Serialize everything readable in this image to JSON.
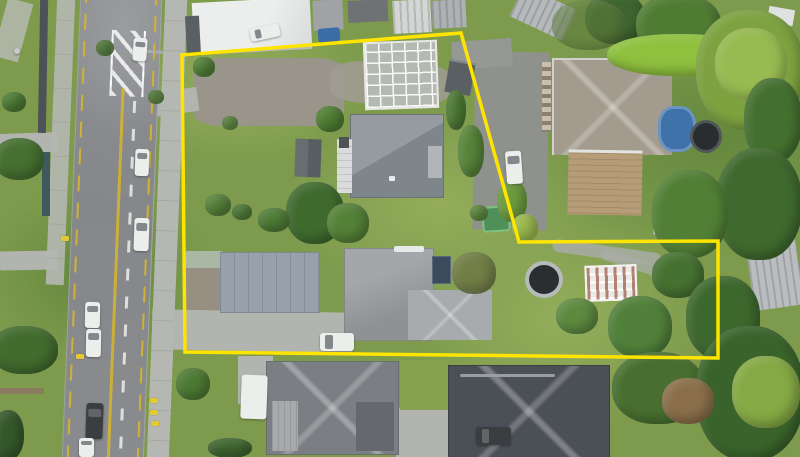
{
  "scene": {
    "kind": "aerial-drone-photo",
    "subject": "residential property lots outlined with a yellow boundary beside a suburban road",
    "visible_text": "none"
  },
  "boundary": {
    "points": "182,55 461,33 519,242 718,241 718,358 185,352",
    "color": "#ffe400",
    "stroke_width": 3.5
  },
  "palette": {
    "grass": "#7e9b4d",
    "grassLight": "#93ad5b",
    "grassDark": "#64883d",
    "road": "#87898c",
    "roadLight": "#9a9c9f",
    "path": "#b5b8b2",
    "concrete": "#b2b4b0",
    "laneYellow": "#d8b62a",
    "laneWhite": "#eceeec",
    "roofGray": "#8d9399",
    "roofHouse2": "#9b9ea1",
    "roofMid": "#7b7f83",
    "roofDark": "#4b4f56",
    "roofTan": "#a39b8e",
    "deckWood": "#b79d77",
    "carportWhite": "#d9dbdc",
    "garageBlue": "#98a1ab",
    "greenRoof": "#a9b8a4",
    "gravel": "#9a958b",
    "poolBlue": "#3f72a8",
    "spaDark": "#2a2d30",
    "tramRing": "#b7babb",
    "tramDark": "#2b2e31",
    "shedGreen": "#4f9058",
    "white": "#eceeec",
    "carDark": "#3b3e41",
    "solar": "#3d4a5c"
  },
  "objects": [
    "road-with-centerline",
    "median-hatch",
    "footpaths",
    "warehouse-roof",
    "yard-sheds",
    "greenhouse",
    "house-top-lot",
    "carport",
    "garden-shed",
    "neighbour-house-ne",
    "timber-deck",
    "blue-pool",
    "spa-circle",
    "garage-bottom-lot",
    "house-bottom-lot",
    "solar-panel",
    "garden-beds",
    "trampoline",
    "glasshouse-frame",
    "neighbour-shed-east",
    "house-south-left",
    "house-south-right",
    "caravan",
    "boundary-outline"
  ],
  "foliage": [
    {
      "x": 585,
      "y": -8,
      "w": 60,
      "h": 52,
      "c": "#3e652f"
    },
    {
      "x": 636,
      "y": -6,
      "w": 85,
      "h": 62,
      "c": "#4f7c33"
    },
    {
      "x": 552,
      "y": 0,
      "w": 74,
      "h": 50,
      "c": "#5c7a3b",
      "o": 0.6
    },
    {
      "x": 607,
      "y": 34,
      "w": 145,
      "h": 42,
      "c": "#8fc13f"
    },
    {
      "x": 696,
      "y": 10,
      "w": 108,
      "h": 120,
      "c": "#7da23f"
    },
    {
      "x": 715,
      "y": 28,
      "w": 72,
      "h": 72,
      "c": "#9dbf55",
      "o": 0.85
    },
    {
      "x": 744,
      "y": 78,
      "w": 58,
      "h": 85,
      "c": "#44702f"
    },
    {
      "x": 716,
      "y": 148,
      "w": 86,
      "h": 112,
      "c": "#3f692e"
    },
    {
      "x": 652,
      "y": 170,
      "w": 76,
      "h": 88,
      "c": "#517f35"
    },
    {
      "x": 446,
      "y": 90,
      "w": 20,
      "h": 40,
      "c": "#4d7a33"
    },
    {
      "x": 458,
      "y": 125,
      "w": 26,
      "h": 52,
      "c": "#578439"
    },
    {
      "x": 497,
      "y": 180,
      "w": 30,
      "h": 42,
      "c": "#6c9a3f"
    },
    {
      "x": 512,
      "y": 214,
      "w": 26,
      "h": 28,
      "c": "#9ab94e"
    },
    {
      "x": 286,
      "y": 182,
      "w": 58,
      "h": 62,
      "c": "#3f6a2e"
    },
    {
      "x": 327,
      "y": 203,
      "w": 42,
      "h": 40,
      "c": "#548138"
    },
    {
      "x": 205,
      "y": 194,
      "w": 26,
      "h": 22,
      "c": "#55823a"
    },
    {
      "x": 232,
      "y": 204,
      "w": 20,
      "h": 16,
      "c": "#4e7c36"
    },
    {
      "x": 258,
      "y": 208,
      "w": 32,
      "h": 24,
      "c": "#4e7c36"
    },
    {
      "x": 316,
      "y": 106,
      "w": 28,
      "h": 26,
      "c": "#4f7d33"
    },
    {
      "x": 193,
      "y": 57,
      "w": 22,
      "h": 20,
      "c": "#517f35"
    },
    {
      "x": 222,
      "y": 116,
      "w": 16,
      "h": 14,
      "c": "#5d8a3f"
    },
    {
      "x": -6,
      "y": 138,
      "w": 50,
      "h": 42,
      "c": "#466f30"
    },
    {
      "x": -10,
      "y": 326,
      "w": 68,
      "h": 48,
      "c": "#426b2e"
    },
    {
      "x": -8,
      "y": 410,
      "w": 32,
      "h": 50,
      "c": "#35582a"
    },
    {
      "x": 2,
      "y": 92,
      "w": 24,
      "h": 20,
      "c": "#4d7a33"
    },
    {
      "x": 608,
      "y": 296,
      "w": 64,
      "h": 62,
      "c": "#50803a"
    },
    {
      "x": 652,
      "y": 252,
      "w": 52,
      "h": 46,
      "c": "#467231"
    },
    {
      "x": 686,
      "y": 276,
      "w": 74,
      "h": 84,
      "c": "#3d682d"
    },
    {
      "x": 612,
      "y": 352,
      "w": 92,
      "h": 72,
      "c": "#486f2f"
    },
    {
      "x": 696,
      "y": 326,
      "w": 108,
      "h": 135,
      "c": "#3a632b"
    },
    {
      "x": 732,
      "y": 356,
      "w": 68,
      "h": 72,
      "c": "#85a944"
    },
    {
      "x": 662,
      "y": 378,
      "w": 52,
      "h": 46,
      "c": "#8a6f4a"
    },
    {
      "x": 556,
      "y": 298,
      "w": 42,
      "h": 36,
      "c": "#5d8a3f"
    },
    {
      "x": 176,
      "y": 368,
      "w": 34,
      "h": 32,
      "c": "#4d7a33"
    },
    {
      "x": 208,
      "y": 438,
      "w": 44,
      "h": 20,
      "c": "#3f652f"
    },
    {
      "x": 452,
      "y": 252,
      "w": 44,
      "h": 42,
      "c": "#6f7a45",
      "o": 0.9
    },
    {
      "x": 470,
      "y": 205,
      "w": 18,
      "h": 16,
      "c": "#5d8a3f"
    },
    {
      "x": 96,
      "y": 40,
      "w": 18,
      "h": 16,
      "c": "#4d7a33",
      "o": 0.9
    },
    {
      "x": 148,
      "y": 90,
      "w": 16,
      "h": 14,
      "c": "#517f35",
      "o": 0.9
    }
  ],
  "vehicles": [
    {
      "name": "white-car-north",
      "x": 133,
      "y": 38,
      "w": 14,
      "h": 23,
      "rot": 4,
      "tone": "light",
      "axis": "v"
    },
    {
      "name": "white-car-mid-1",
      "x": 135,
      "y": 149,
      "w": 14,
      "h": 27,
      "rot": 2,
      "tone": "light",
      "axis": "v"
    },
    {
      "name": "white-car-mid-2",
      "x": 134,
      "y": 218,
      "w": 15,
      "h": 33,
      "rot": 2,
      "tone": "light",
      "axis": "v"
    },
    {
      "name": "white-van-parked-1",
      "x": 85,
      "y": 302,
      "w": 15,
      "h": 26,
      "rot": 1,
      "tone": "light",
      "axis": "v"
    },
    {
      "name": "white-van-parked-2",
      "x": 86,
      "y": 329,
      "w": 15,
      "h": 28,
      "rot": 1,
      "tone": "light",
      "axis": "v"
    },
    {
      "name": "dark-car-parked",
      "x": 86,
      "y": 403,
      "w": 17,
      "h": 36,
      "rot": 2,
      "tone": "dark",
      "axis": "v"
    },
    {
      "name": "white-car-south",
      "x": 79,
      "y": 438,
      "w": 15,
      "h": 19,
      "rot": 0,
      "tone": "light",
      "axis": "v"
    },
    {
      "name": "white-car-neighbour-drive",
      "x": 506,
      "y": 151,
      "w": 16,
      "h": 33,
      "rot": -4,
      "tone": "light",
      "axis": "v"
    },
    {
      "name": "white-car-front-yard",
      "x": 320,
      "y": 333,
      "w": 34,
      "h": 18,
      "rot": 0,
      "tone": "light",
      "axis": "h"
    },
    {
      "name": "white-caravan",
      "x": 241,
      "y": 375,
      "w": 26,
      "h": 44,
      "rot": 2,
      "tone": "light",
      "axis": "n"
    },
    {
      "name": "dark-car-south-house",
      "x": 476,
      "y": 427,
      "w": 35,
      "h": 18,
      "rot": 0,
      "tone": "dark",
      "axis": "h"
    },
    {
      "name": "white-truck-yard",
      "x": 250,
      "y": 26,
      "w": 30,
      "h": 13,
      "rot": -12,
      "tone": "light",
      "axis": "h"
    }
  ],
  "kerb_markers": [
    {
      "x": 150,
      "y": 398
    },
    {
      "x": 150,
      "y": 410
    },
    {
      "x": 151,
      "y": 421
    },
    {
      "x": 61,
      "y": 236
    },
    {
      "x": 76,
      "y": 354
    }
  ]
}
